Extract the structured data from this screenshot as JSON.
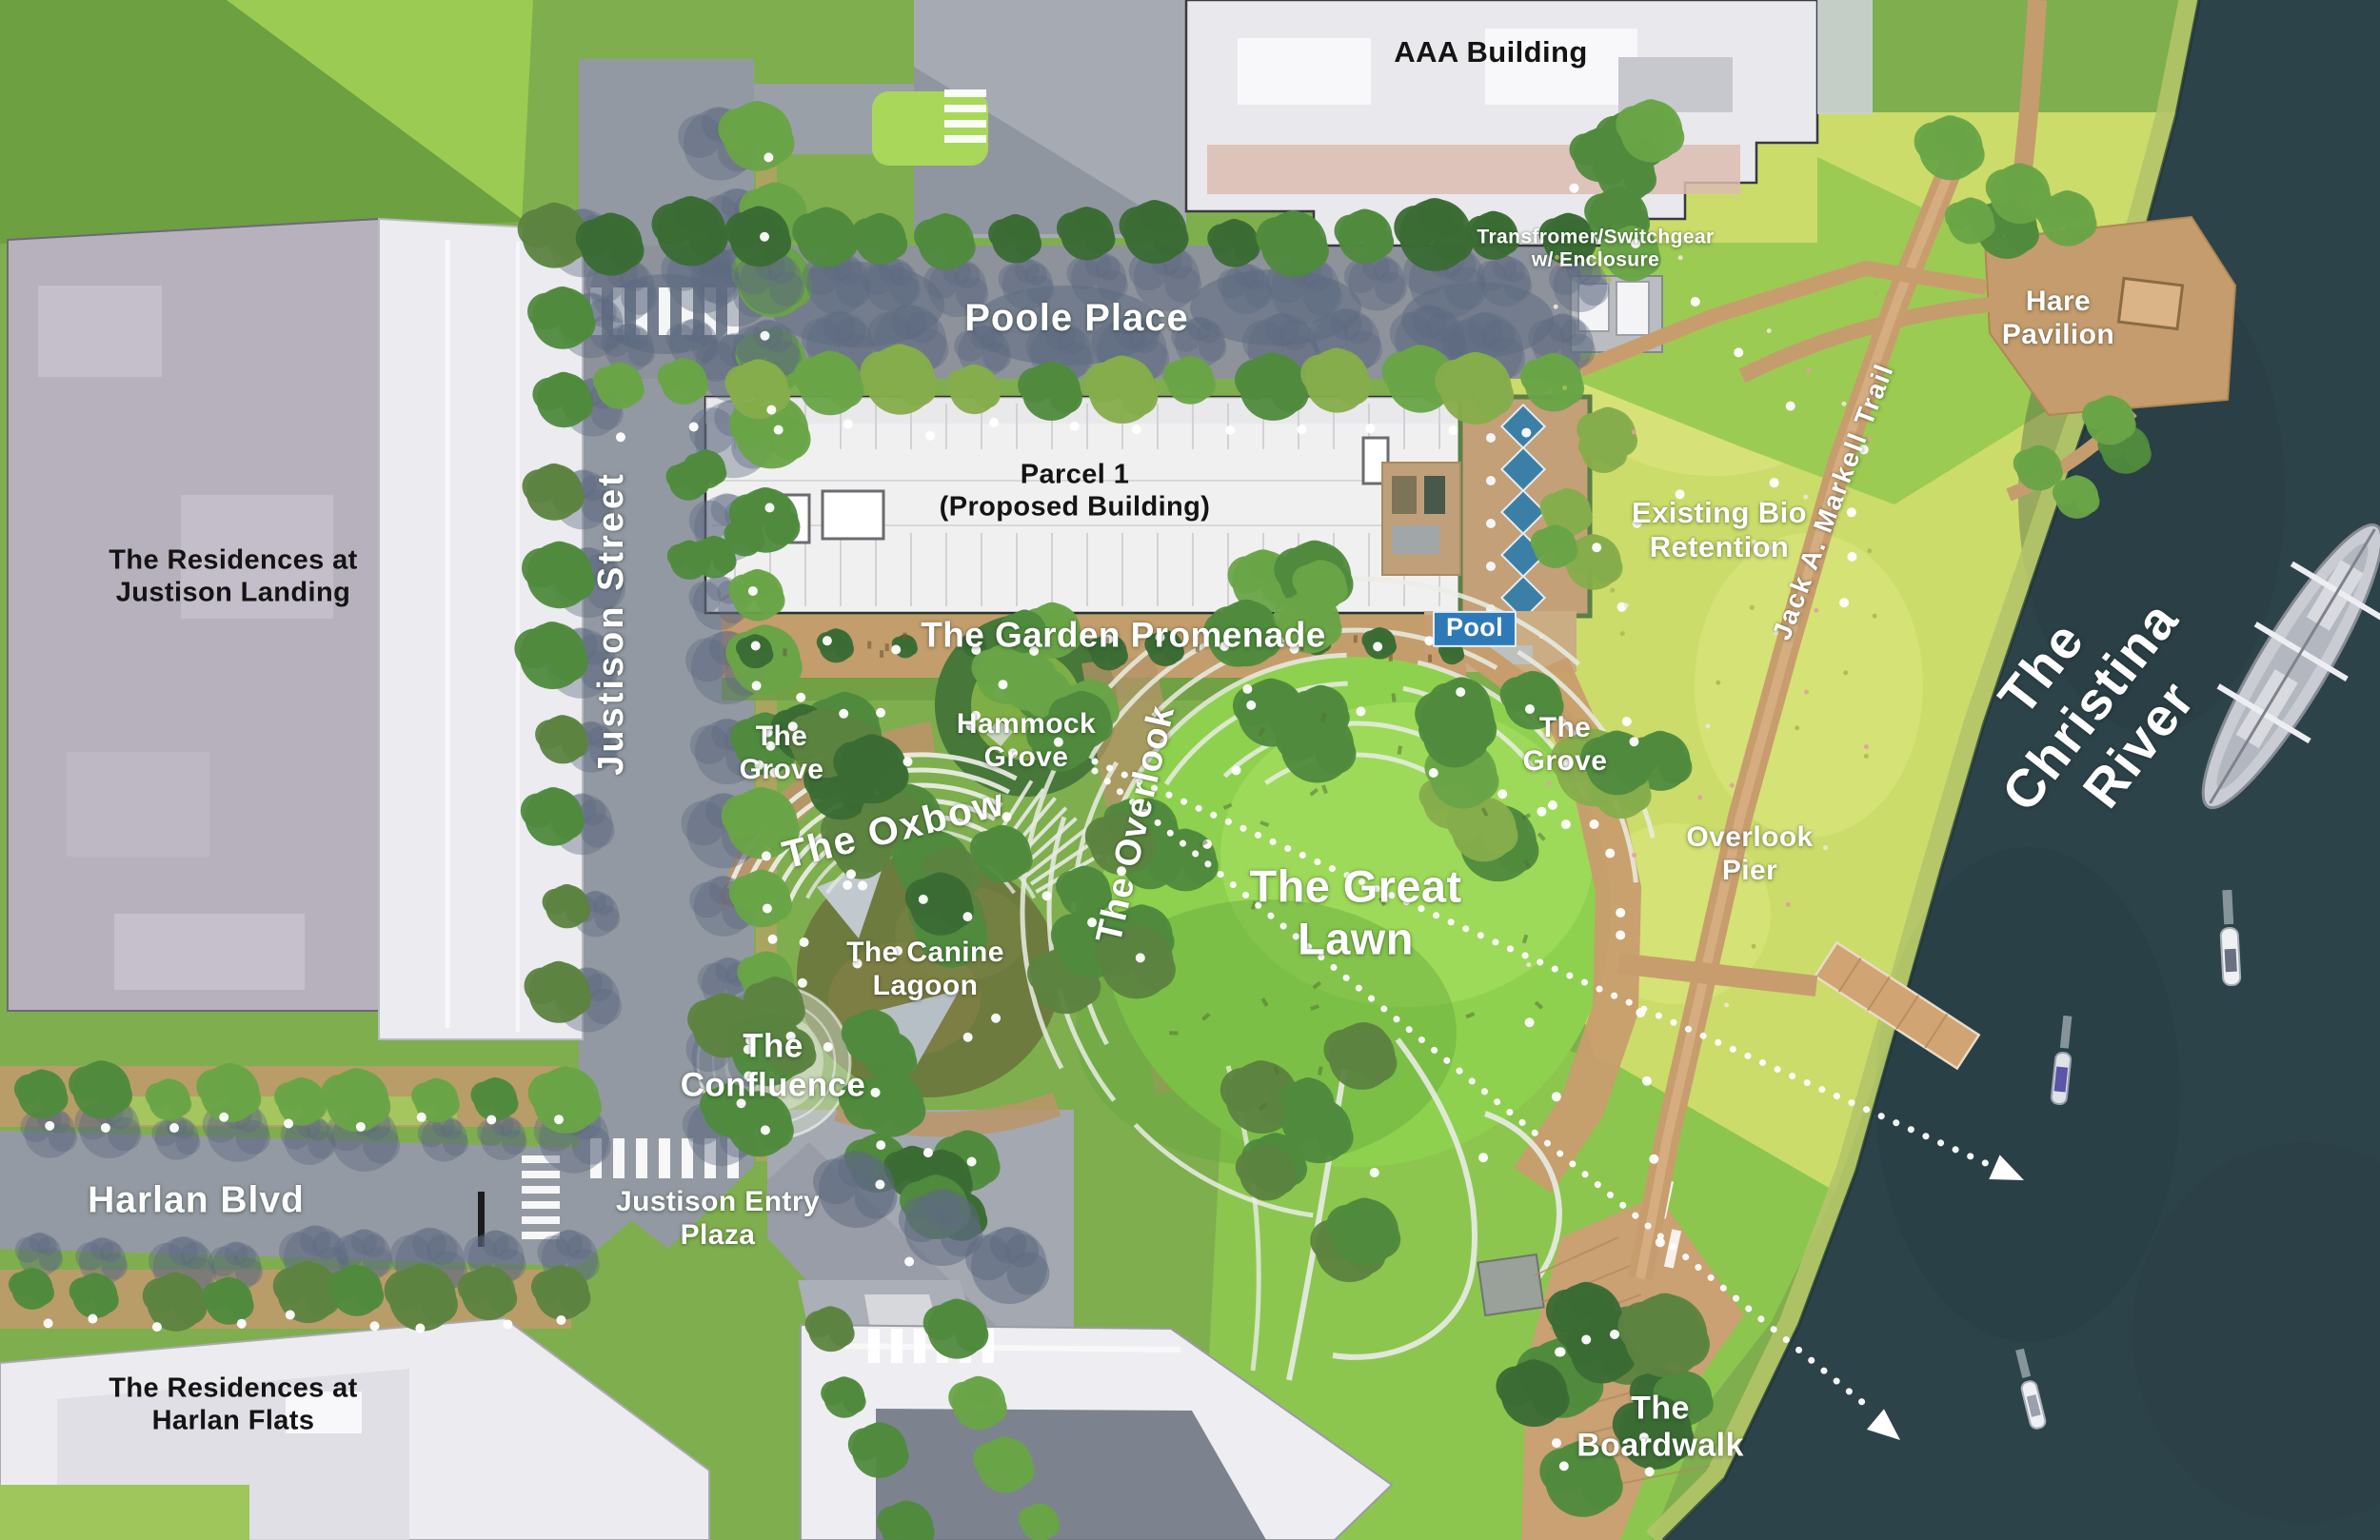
{
  "map": {
    "labels": {
      "aaa_building": "AAA Building",
      "transformer": "Transfromer/Switchgear\nw/ Enclosure",
      "hare_pavilion": "Hare\nPavilion",
      "poole_place": "Poole Place",
      "parcel_1": "Parcel 1\n(Proposed Building)",
      "existing_bio_retention": "Existing Bio\nRetention",
      "jack_markell_trail": "Jack A. Markell Trail",
      "christina_river": "The Christina River",
      "garden_promenade": "The Garden Promenade",
      "pool": "Pool",
      "hammock_grove": "Hammock\nGrove",
      "grove_west": "The\nGrove",
      "grove_east": "The\nGrove",
      "oxbow": "The Oxbow",
      "overlook": "The Overlook",
      "great_lawn": "The Great\nLawn",
      "overlook_pier": "Overlook\nPier",
      "canine_lagoon": "The Canine\nLagoon",
      "confluence": "The\nConfluence",
      "residences_justison_landing": "The Residences at\nJustison Landing",
      "justison_street": "Justison Street",
      "harlan_blvd": "Harlan Blvd",
      "justison_entry_plaza": "Justison Entry\nPlaza",
      "residences_harlan_flats": "The Residences at\nHarlan Flats",
      "boardwalk": "The\nBoardwalk"
    },
    "colors": {
      "water": "#2d434a",
      "meadow": "#cbdc6a",
      "great_lawn": "#8ed14e",
      "tree_green": "#4f8a3d",
      "path_tan": "#c89d6e",
      "road_gray": "#9399a2",
      "building_white": "#f0f0f1",
      "residential_gray": "#b7b1be",
      "pool_blue": "#3f86ad",
      "pool_chip_blue": "#2e7ab8",
      "label_white": "#ffffff",
      "label_black": "#141414"
    }
  }
}
